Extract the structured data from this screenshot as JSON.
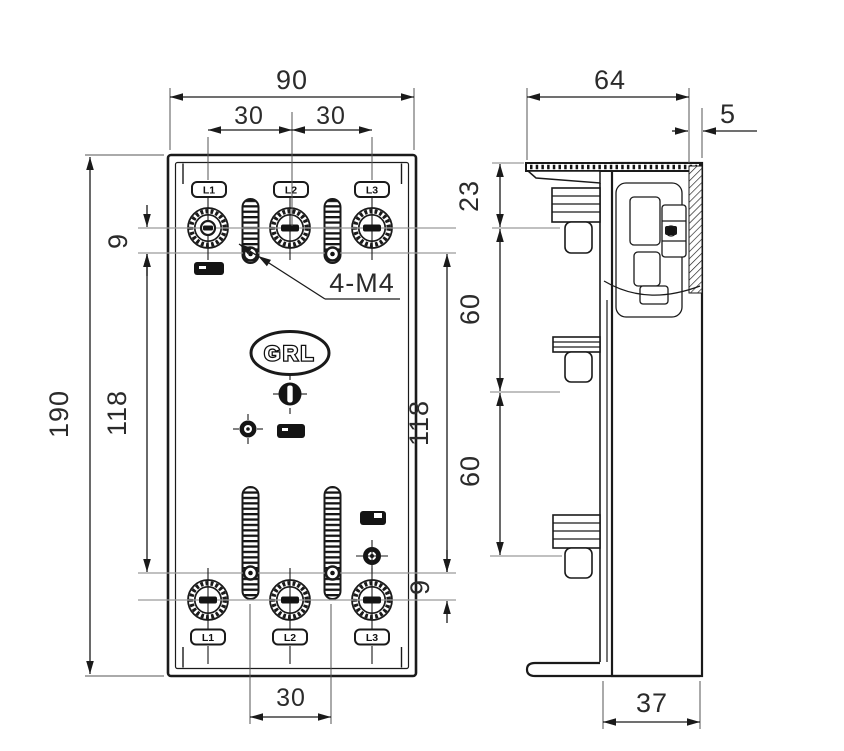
{
  "front_view": {
    "logo": "GRL",
    "thread_note": "4-M4",
    "top_terminals": [
      "L1",
      "L2",
      "L3"
    ],
    "bottom_terminals": [
      "L1",
      "L2",
      "L3"
    ],
    "dimensions": {
      "overall_width": "90",
      "terminal_pitch_left": "30",
      "terminal_pitch_right": "30",
      "overall_height": "190",
      "mount_hole_span_left": "118",
      "mount_hole_span_right": "118",
      "mount_hole_offset_top": "9",
      "mount_hole_offset_bottom": "9",
      "bottom_slot_pitch": "30"
    }
  },
  "side_view": {
    "dimensions": {
      "overall_depth": "64",
      "top_flange_depth": "5",
      "top_to_first_terminal": "23",
      "terminal_pitch_upper": "60",
      "terminal_pitch_lower": "60",
      "base_depth": "37"
    }
  },
  "colors": {
    "line": "#1a1a1a",
    "centerline": "#9a9a9a",
    "background": "#ffffff"
  }
}
